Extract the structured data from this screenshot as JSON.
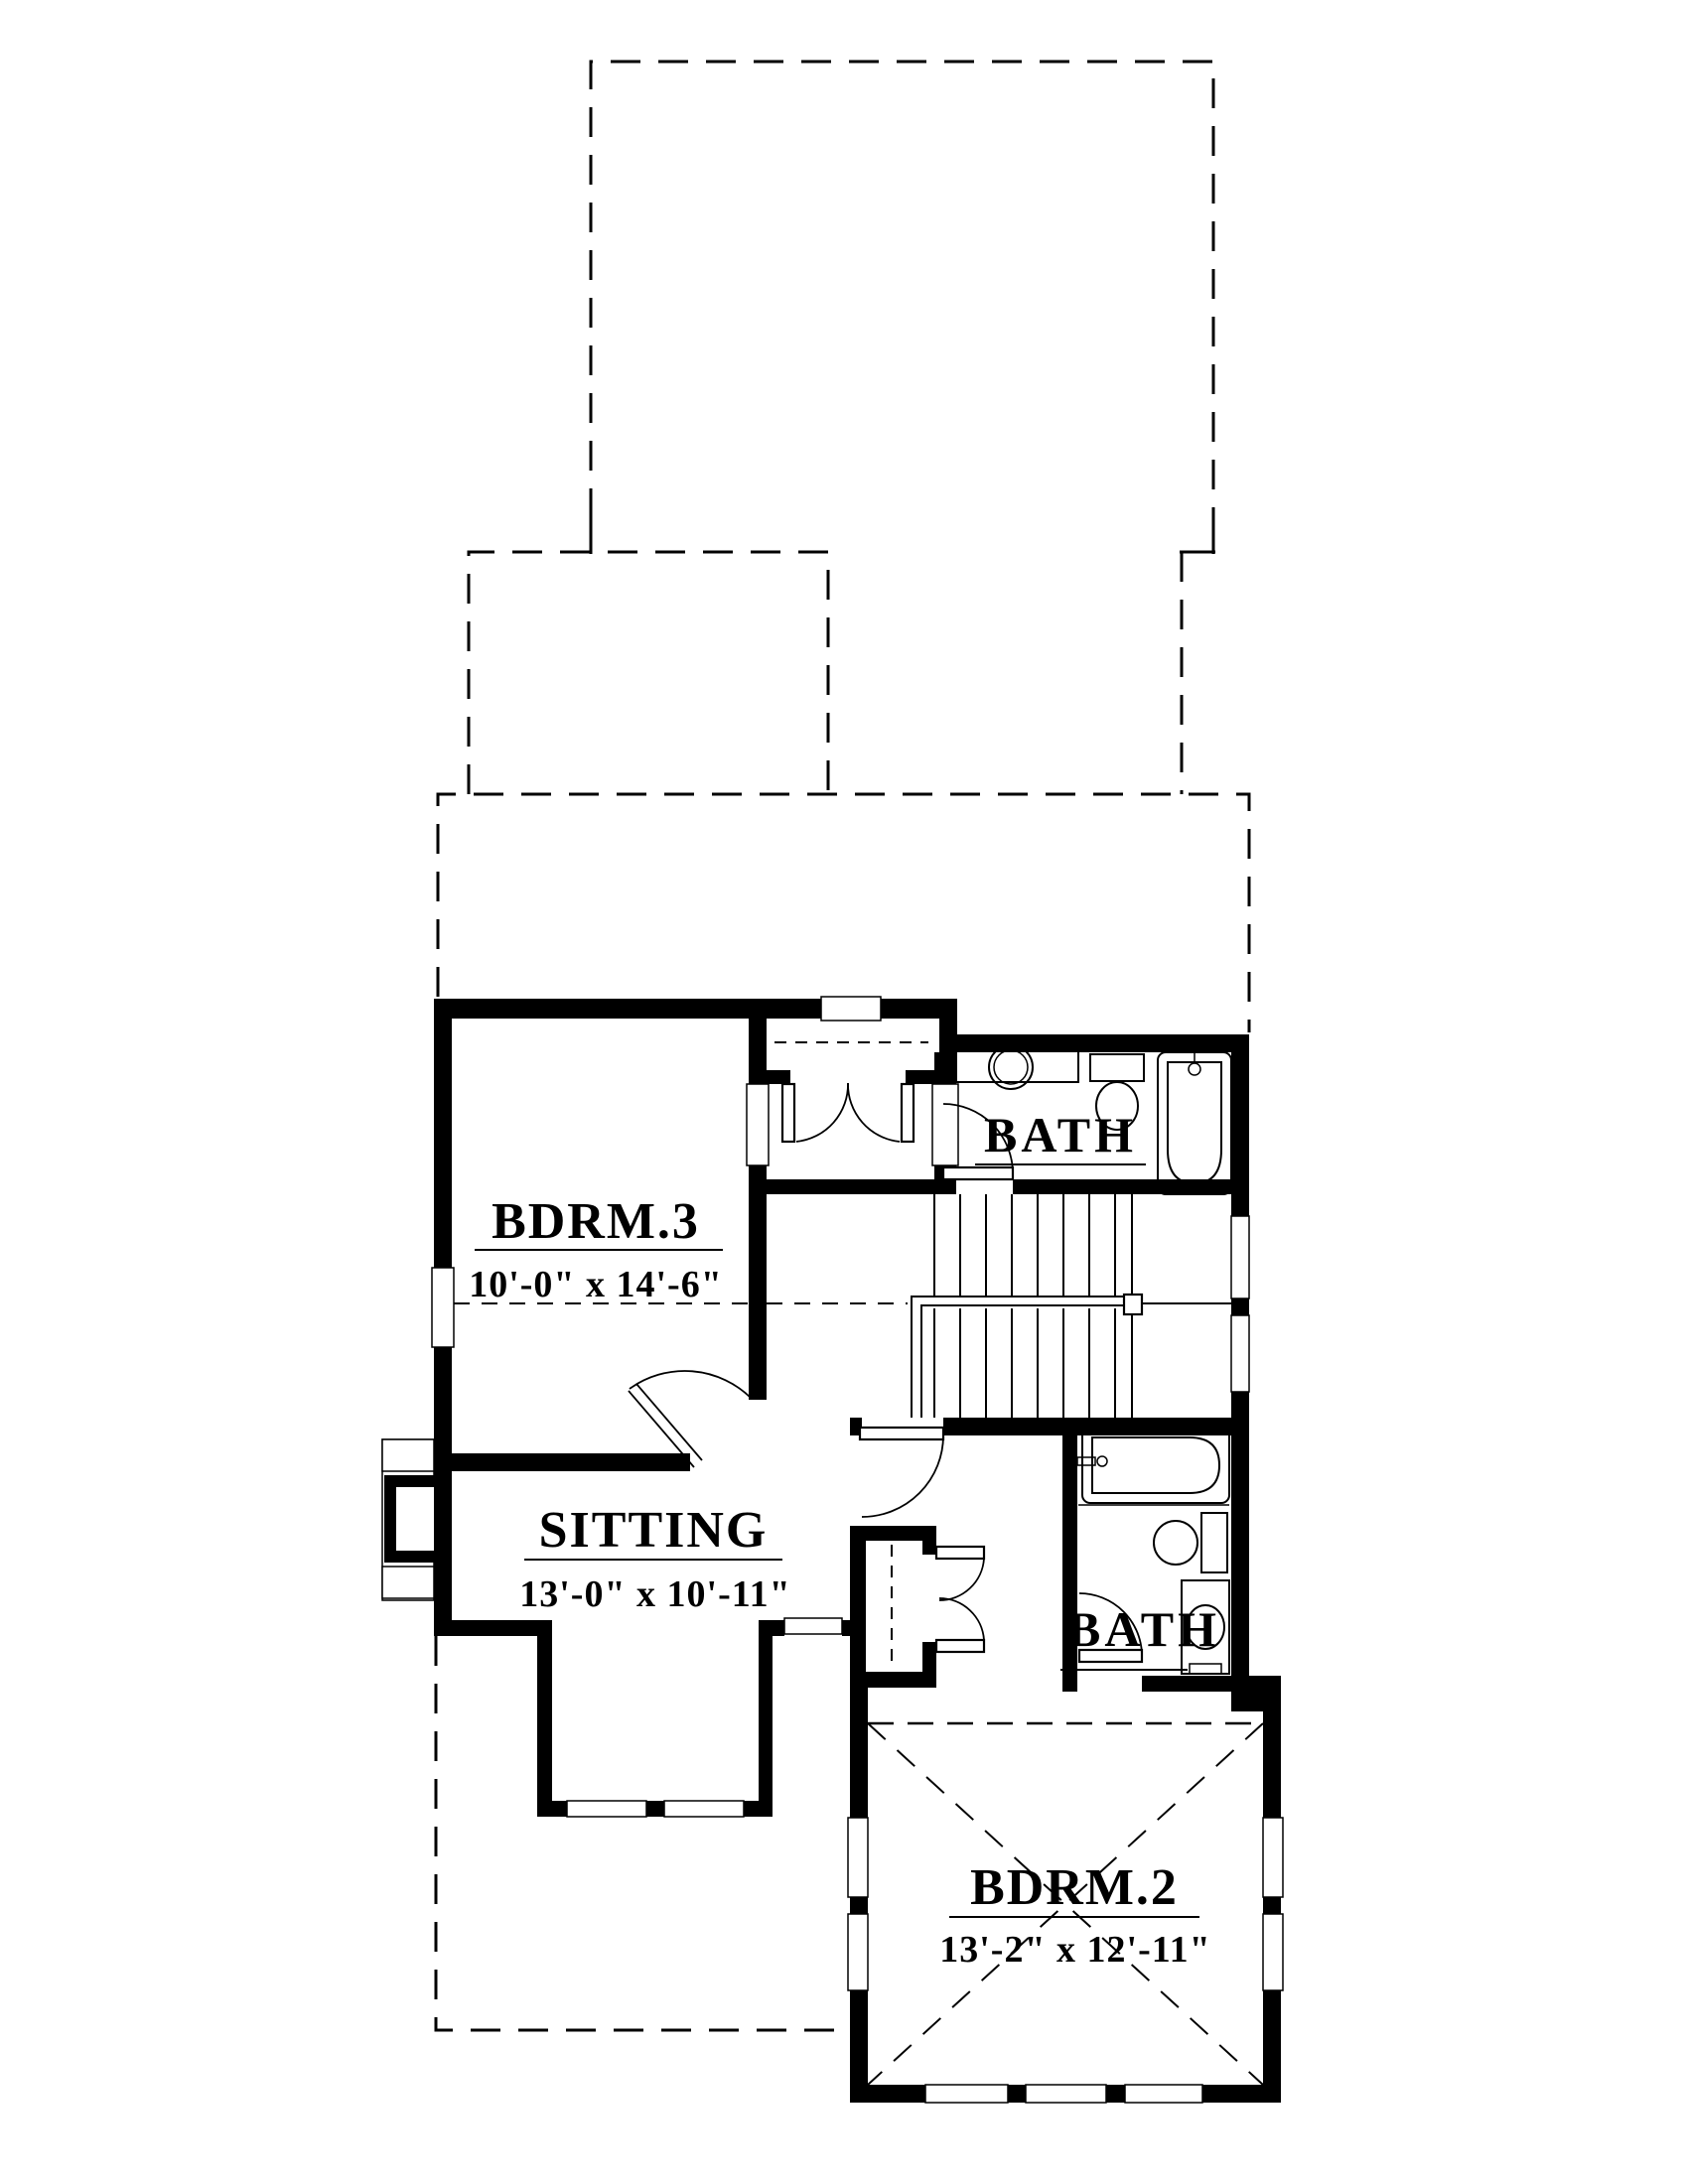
{
  "document": {
    "type": "architectural floor plan",
    "ink_color": "#000000",
    "paper_color": "#ffffff"
  },
  "rooms": [
    {
      "name": "BDRM.3",
      "dimensions": "10'-0\" x 14'-6\""
    },
    {
      "name": "SITTING",
      "dimensions": "13'-0\" x 10'-11\""
    },
    {
      "name": "BATH"
    },
    {
      "name": "BATH"
    },
    {
      "name": "BDRM.2",
      "dimensions": "13'-2\" x 12'-11\""
    }
  ],
  "symbols": [
    "exterior-wall",
    "interior-wall",
    "window",
    "door-swing",
    "double-closet-doors",
    "cased-opening",
    "stairs-with-handrail",
    "bathtub",
    "toilet",
    "vanity-sink",
    "chimney-box",
    "roof-outline-dashed",
    "ceiling-break-dashed",
    "tray-ceiling-cross"
  ]
}
